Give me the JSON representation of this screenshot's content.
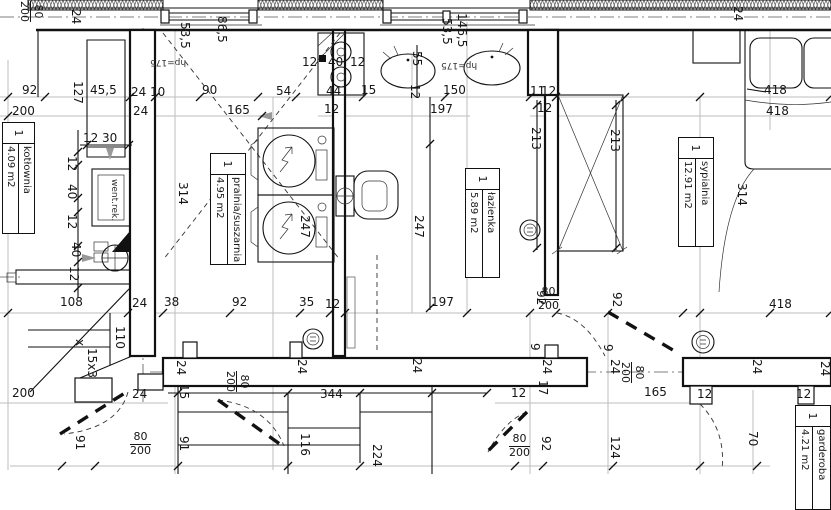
{
  "drawing_type": "architectural floor plan",
  "rooms": [
    {
      "n": "room-label-kotlownia",
      "number": "1",
      "name": "kotłownia",
      "area": "4.09 m2",
      "x": 35,
      "y": 122,
      "len": 112,
      "th": 33
    },
    {
      "n": "room-label-pralnia",
      "number": "1",
      "name": "pralnia/suszarnia",
      "area": "4.95 m2",
      "x": 246,
      "y": 153,
      "len": 112,
      "th": 36
    },
    {
      "n": "room-label-lazienka",
      "number": "1",
      "name": "łazienka",
      "area": "5.89 m2",
      "x": 500,
      "y": 168,
      "len": 110,
      "th": 35
    },
    {
      "n": "room-label-sypialnia",
      "number": "1",
      "name": "sypialnia",
      "area": "12.91 m2",
      "x": 714,
      "y": 137,
      "len": 110,
      "th": 36
    },
    {
      "n": "room-label-garderoba",
      "number": "1",
      "name": "garderoba",
      "area": "4.21 m2",
      "x": 831,
      "y": 405,
      "len": 105,
      "th": 36
    }
  ],
  "door_sizes": [
    {
      "w": "80",
      "h": "200",
      "x": 44,
      "y": 1,
      "r": 90
    },
    {
      "w": "80",
      "h": "200",
      "x": 538,
      "y": 286,
      "r": 0
    },
    {
      "w": "80",
      "h": "200",
      "x": 130,
      "y": 431,
      "r": 0
    },
    {
      "w": "80",
      "h": "200",
      "x": 509,
      "y": 433,
      "r": 0
    },
    {
      "w": "80",
      "h": "200",
      "x": 250,
      "y": 371,
      "r": 90
    },
    {
      "w": "80",
      "h": "200",
      "x": 645,
      "y": 362,
      "r": 90
    }
  ],
  "texts": [
    {
      "t": "92",
      "x": 22,
      "y": 84
    },
    {
      "t": "45,5",
      "x": 90,
      "y": 84
    },
    {
      "t": "24",
      "x": 131,
      "y": 86
    },
    {
      "t": "10",
      "x": 150,
      "y": 86
    },
    {
      "t": "90",
      "x": 202,
      "y": 84
    },
    {
      "t": "54",
      "x": 276,
      "y": 85
    },
    {
      "t": "44",
      "x": 326,
      "y": 85
    },
    {
      "t": "15",
      "x": 361,
      "y": 84
    },
    {
      "t": "150",
      "x": 443,
      "y": 84
    },
    {
      "t": "11",
      "x": 530,
      "y": 85
    },
    {
      "t": "12",
      "x": 541,
      "y": 85
    },
    {
      "t": "418",
      "x": 764,
      "y": 84
    },
    {
      "t": "200",
      "x": 12,
      "y": 105
    },
    {
      "t": "24",
      "x": 133,
      "y": 105
    },
    {
      "t": "165",
      "x": 227,
      "y": 104
    },
    {
      "t": "12",
      "x": 324,
      "y": 103
    },
    {
      "t": "197",
      "x": 430,
      "y": 103
    },
    {
      "t": "12",
      "x": 537,
      "y": 102
    },
    {
      "t": "418",
      "x": 766,
      "y": 105
    },
    {
      "t": "12",
      "x": 83,
      "y": 132
    },
    {
      "t": "30",
      "x": 102,
      "y": 132
    },
    {
      "t": "12",
      "x": 302,
      "y": 56
    },
    {
      "t": "40",
      "x": 328,
      "y": 56
    },
    {
      "t": "12",
      "x": 350,
      "y": 56
    },
    {
      "t": "108",
      "x": 60,
      "y": 296
    },
    {
      "t": "24",
      "x": 132,
      "y": 297
    },
    {
      "t": "38",
      "x": 164,
      "y": 296
    },
    {
      "t": "92",
      "x": 232,
      "y": 296
    },
    {
      "t": "35",
      "x": 299,
      "y": 296
    },
    {
      "t": "12",
      "x": 325,
      "y": 298
    },
    {
      "t": "197",
      "x": 431,
      "y": 296
    },
    {
      "t": "418",
      "x": 769,
      "y": 298
    },
    {
      "t": "200",
      "x": 12,
      "y": 387
    },
    {
      "t": "24",
      "x": 132,
      "y": 388
    },
    {
      "t": "344",
      "x": 320,
      "y": 388
    },
    {
      "t": "12",
      "x": 511,
      "y": 387
    },
    {
      "t": "165",
      "x": 644,
      "y": 386
    },
    {
      "t": "12",
      "x": 697,
      "y": 388
    },
    {
      "t": "12",
      "x": 796,
      "y": 388
    },
    {
      "t": "24",
      "x": 82,
      "y": 9,
      "r": 90
    },
    {
      "t": "127",
      "x": 84,
      "y": 81,
      "r": 90
    },
    {
      "t": "53,5",
      "x": 191,
      "y": 22,
      "r": 90
    },
    {
      "t": "86,5",
      "x": 228,
      "y": 16,
      "r": 90
    },
    {
      "t": "12",
      "x": 78,
      "y": 156,
      "r": 90
    },
    {
      "t": "40",
      "x": 78,
      "y": 184,
      "r": 90
    },
    {
      "t": "12",
      "x": 78,
      "y": 214,
      "r": 90
    },
    {
      "t": "40",
      "x": 82,
      "y": 242,
      "r": 90
    },
    {
      "t": "12",
      "x": 80,
      "y": 266,
      "r": 90
    },
    {
      "t": "314",
      "x": 189,
      "y": 182,
      "r": 90
    },
    {
      "t": "247",
      "x": 311,
      "y": 215,
      "r": 90
    },
    {
      "t": "55",
      "x": 423,
      "y": 51,
      "r": 90
    },
    {
      "t": "12",
      "x": 421,
      "y": 84,
      "r": 90
    },
    {
      "t": "53,5",
      "x": 453,
      "y": 18,
      "r": 90
    },
    {
      "t": "146,5",
      "x": 468,
      "y": 13,
      "r": 90
    },
    {
      "t": "213",
      "x": 542,
      "y": 127,
      "r": 90
    },
    {
      "t": "213",
      "x": 621,
      "y": 129,
      "r": 90
    },
    {
      "t": "24",
      "x": 744,
      "y": 6,
      "r": 90
    },
    {
      "t": "314",
      "x": 748,
      "y": 183,
      "r": 90
    },
    {
      "t": "247",
      "x": 425,
      "y": 215,
      "r": 90
    },
    {
      "t": "92",
      "x": 547,
      "y": 290,
      "r": 90
    },
    {
      "t": "92",
      "x": 623,
      "y": 292,
      "r": 90
    },
    {
      "t": "9",
      "x": 541,
      "y": 343,
      "r": 90
    },
    {
      "t": "24",
      "x": 553,
      "y": 359,
      "r": 90
    },
    {
      "t": "17",
      "x": 549,
      "y": 380,
      "r": 90
    },
    {
      "t": "9",
      "x": 614,
      "y": 344,
      "r": 90
    },
    {
      "t": "24",
      "x": 621,
      "y": 359,
      "r": 90
    },
    {
      "t": "110",
      "x": 126,
      "y": 326,
      "r": 90
    },
    {
      "t": "x",
      "x": 86,
      "y": 339,
      "r": 90
    },
    {
      "t": "15x3",
      "x": 98,
      "y": 348,
      "r": 90
    },
    {
      "t": "24",
      "x": 187,
      "y": 360,
      "r": 90
    },
    {
      "t": "15",
      "x": 190,
      "y": 384,
      "r": 90
    },
    {
      "t": "91",
      "x": 86,
      "y": 435,
      "r": 90
    },
    {
      "t": "91",
      "x": 190,
      "y": 436,
      "r": 90
    },
    {
      "t": "116",
      "x": 311,
      "y": 433,
      "r": 90
    },
    {
      "t": "224",
      "x": 383,
      "y": 444,
      "r": 90
    },
    {
      "t": "92",
      "x": 552,
      "y": 436,
      "r": 90
    },
    {
      "t": "124",
      "x": 621,
      "y": 436,
      "r": 90
    },
    {
      "t": "70",
      "x": 759,
      "y": 431,
      "r": 90
    },
    {
      "t": "24",
      "x": 308,
      "y": 359,
      "r": 90
    },
    {
      "t": "24",
      "x": 423,
      "y": 358,
      "r": 90
    },
    {
      "t": "24",
      "x": 763,
      "y": 359,
      "r": 90
    },
    {
      "t": "24",
      "x": 831,
      "y": 361,
      "r": 90
    },
    {
      "t": "hp=175",
      "x": 150,
      "y": 57,
      "r": 180,
      "s": "sm",
      "n": "window-sill-height-label"
    },
    {
      "t": "hp=175",
      "x": 441,
      "y": 60,
      "r": 180,
      "s": "sm",
      "n": "window-sill-height-label"
    },
    {
      "t": "went.rek.",
      "x": 118,
      "y": 179,
      "r": 90,
      "s": "sm",
      "n": "vent-unit-label"
    }
  ]
}
